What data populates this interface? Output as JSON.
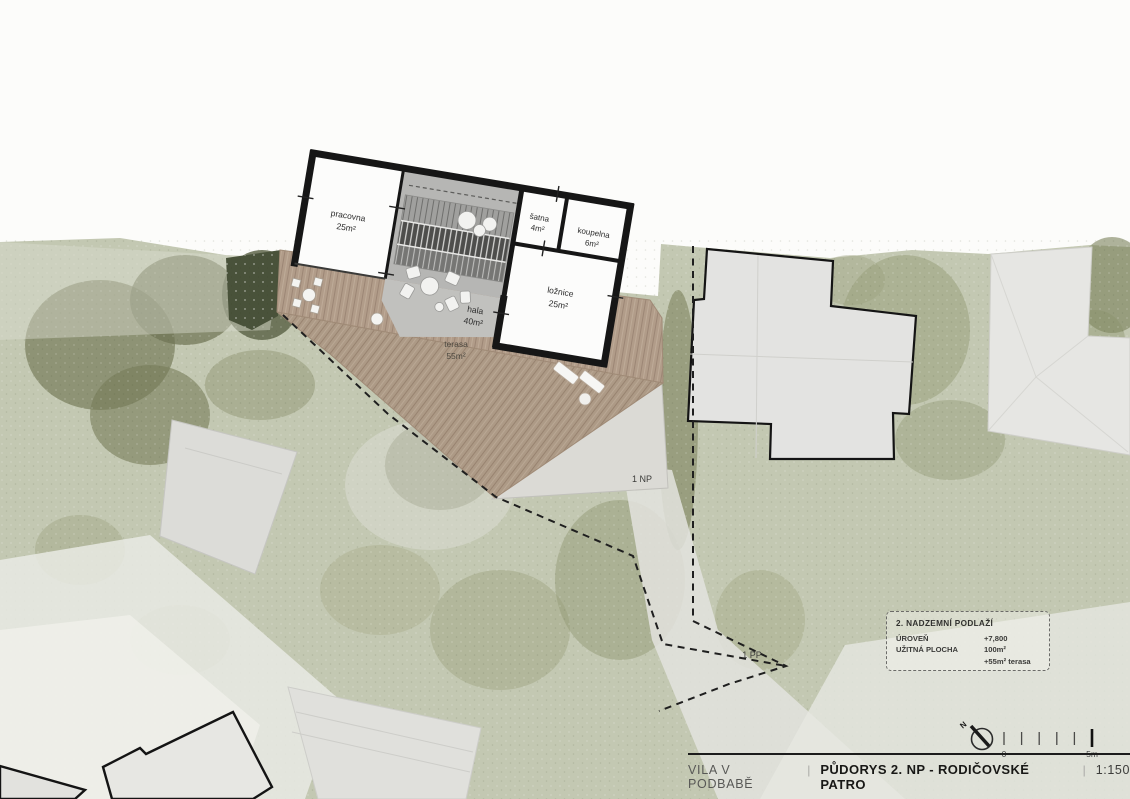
{
  "plan": {
    "rooms": [
      {
        "name": "pracovna",
        "area": "25m²"
      },
      {
        "name": "hala",
        "area": "40m²"
      },
      {
        "name": "šatna",
        "area": "4m²"
      },
      {
        "name": "koupelna",
        "area": "6m²"
      },
      {
        "name": "ložnice",
        "area": "25m²"
      },
      {
        "name": "terasa",
        "area": "55m²"
      }
    ],
    "level_markers": {
      "first_floor": "1 NP",
      "basement": "1 PP"
    }
  },
  "legend_box": {
    "title": "2. NADZEMNÍ PODLAŽÍ",
    "rows": [
      {
        "label": "ÚROVEŇ",
        "value": "+7,800"
      },
      {
        "label": "UŽITNÁ PLOCHA",
        "value": "100m²"
      },
      {
        "label": "",
        "value": "+55m² terasa"
      }
    ]
  },
  "title_bar": {
    "project": "VILA V PODBABĚ",
    "separator": "|",
    "drawing_title": "PŮDORYS 2. NP - RODIČOVSKÉ PATRO",
    "scale": "1:150"
  },
  "scale_bar": {
    "zero_label": "0",
    "max_label": "5m",
    "north_label": "N"
  },
  "colors": {
    "wall": "#161616",
    "wood_deck": "#b19c89",
    "terrain": "#c3c8b2",
    "hala_floor": "#b6b6b4",
    "neighbor_fill": "#e3e3e1",
    "dashed_line": "#1f1f1f"
  }
}
